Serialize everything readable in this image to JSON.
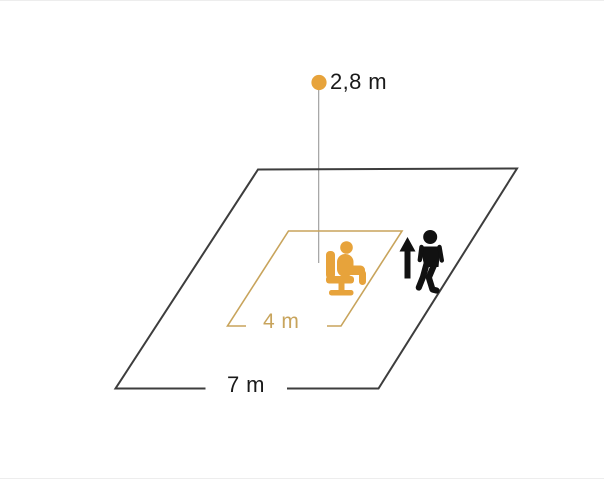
{
  "diagram": {
    "labels": {
      "mounting_height": "2,8 m",
      "seated_range": "4 m",
      "walking_range": "7 m"
    },
    "icons": {
      "sensor_dot": "sensor-dot-icon",
      "seated_person": "seated-person-icon",
      "walking_person": "walking-person-icon",
      "up_arrow": "up-arrow-icon"
    },
    "colors": {
      "accent_orange": "#E7A33B",
      "range_outline": "#C8A45C",
      "outline_dark": "#3D3D3D",
      "plumb_line": "#999999",
      "figure_black": "#111111",
      "background": "#FFFFFF"
    }
  }
}
